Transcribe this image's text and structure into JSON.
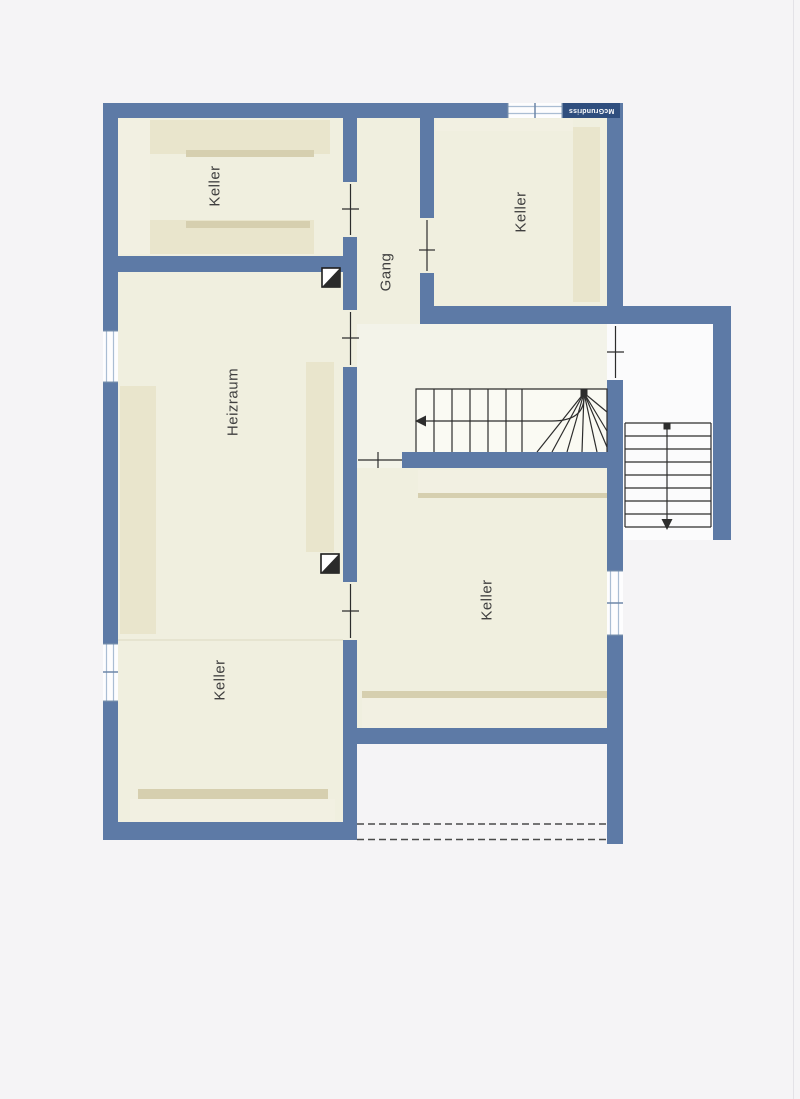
{
  "watermark": {
    "text": "McGrundriss"
  },
  "rooms": [
    {
      "id": "keller-top-left",
      "label": "Keller"
    },
    {
      "id": "keller-top-right",
      "label": "Keller"
    },
    {
      "id": "gang",
      "label": "Gang"
    },
    {
      "id": "heizraum",
      "label": "Heizraum"
    },
    {
      "id": "keller-bottom-left",
      "label": "Keller"
    },
    {
      "id": "keller-main",
      "label": "Keller"
    }
  ],
  "icons": [
    "chimney-icon",
    "stair-direction-arrow-icon",
    "door-opening-tick-icon",
    "window-symbol-icon"
  ],
  "colors": {
    "page_bg": "#f5f4f6",
    "wall": "#5d7aa6",
    "wall_dark": "#2f4e7e",
    "room_fill": "#f0efdf",
    "hall_fill": "#f3f3e9",
    "stair_fill": "#fafaf3",
    "outside_fill": "#fbfbfc",
    "furn": "#e9e5cc",
    "furn_edge": "#d6cfaf",
    "furn_light": "#f2f0e2",
    "win_fill": "#fdfdfe",
    "win_line": "#aabdd3",
    "win_cap": "#6d87a8",
    "line": "#2d2d2d",
    "dash": "#4a4a4a",
    "label": "#3f3f3f",
    "divider": "#ddd8c2"
  }
}
